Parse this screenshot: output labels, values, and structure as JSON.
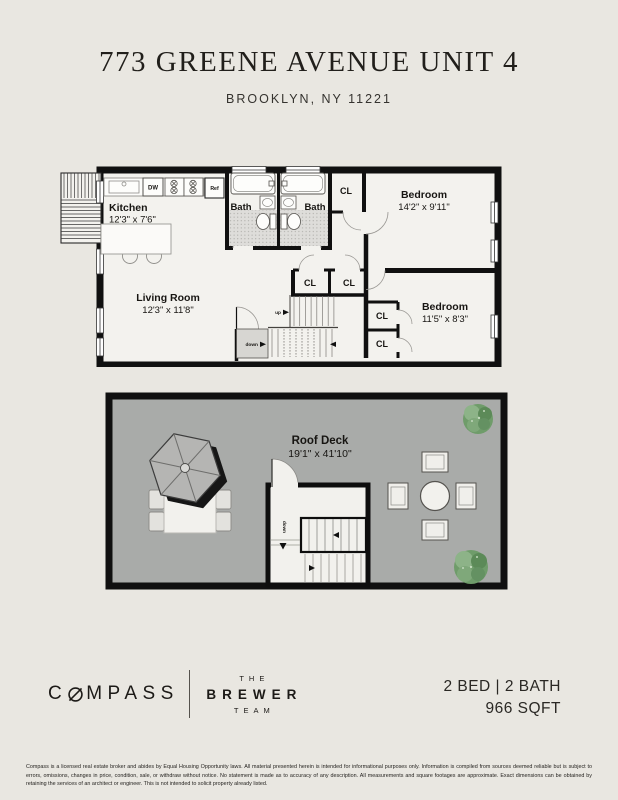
{
  "header": {
    "title": "773 GREENE AVENUE UNIT 4",
    "subtitle": "BROOKLYN, NY 11221"
  },
  "colors": {
    "background": "#e9e7e1",
    "wall": "#101010",
    "plan_floor": "#f3f2ee",
    "deck_gray": "#a9aba9",
    "plant_green": "#6f9c6a"
  },
  "plan_main": {
    "kitchen": {
      "name": "Kitchen",
      "dims": "12'3\" x 7'6\""
    },
    "living": {
      "name": "Living Room",
      "dims": "12'3\" x 11'8\""
    },
    "bath1": {
      "name": "Bath"
    },
    "bath2": {
      "name": "Bath"
    },
    "bedroom1": {
      "name": "Bedroom",
      "dims": "14'2\" x 9'11\""
    },
    "bedroom2": {
      "name": "Bedroom",
      "dims": "11'5\" x 8'3\""
    },
    "closet": "CL",
    "appliances": {
      "dw": "DW",
      "ref": "Ref"
    },
    "stairs": {
      "up": "up",
      "down": "down"
    }
  },
  "plan_roof": {
    "name": "Roof Deck",
    "dims": "19'1\" x 41'10\"",
    "stairs_down": "down"
  },
  "footer": {
    "brand": {
      "text": "COMPASS",
      "c": "C",
      "rest": "MPASS"
    },
    "team": {
      "line1": "THE",
      "line2": "BREWER",
      "line3": "TEAM"
    },
    "stats": {
      "line1": "2 BED | 2 BATH",
      "line2": "966 SQFT"
    },
    "disclaimer": "Compass is a licensed real estate broker and abides by Equal Housing Opportunity laws. All material presented herein is intended for informational purposes only. Information is compiled from sources deemed reliable but is subject to errors, omissions, changes in price, condition, sale, or withdraw without notice. No statement is made as to accuracy of any description. All measurements and square footages are approximate. Exact dimensions can be obtained by retaining the services of an architect or engineer. This is not intended to solicit property already listed."
  }
}
